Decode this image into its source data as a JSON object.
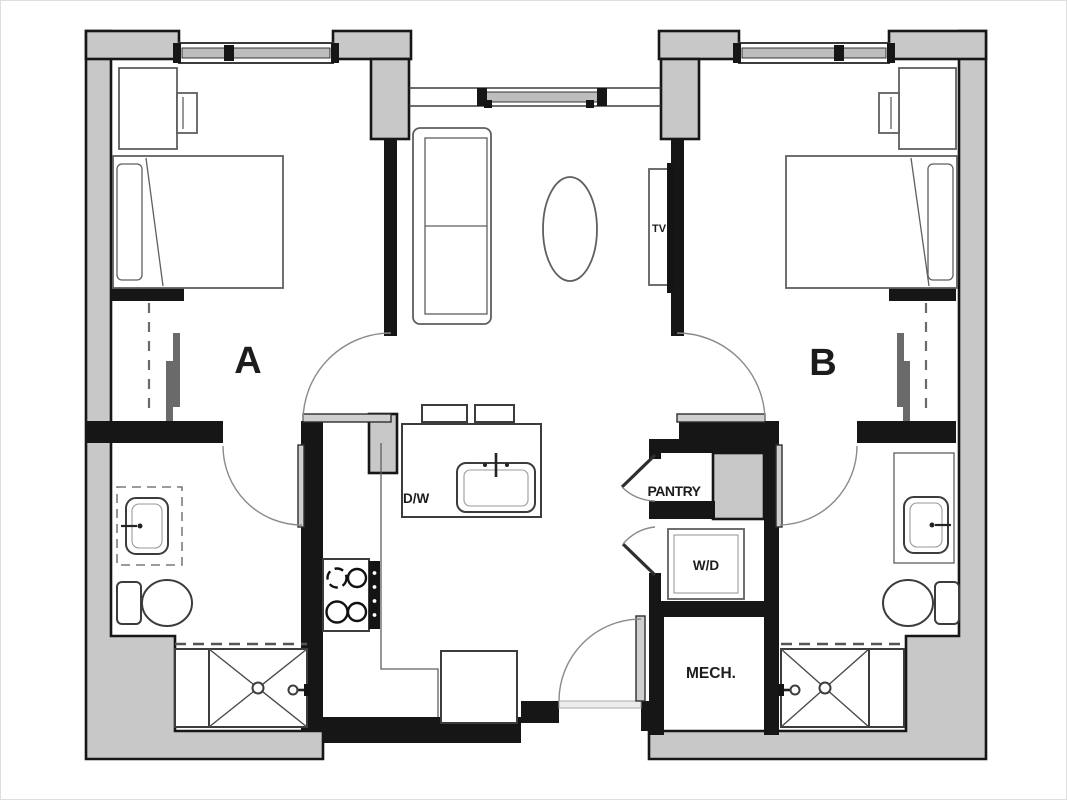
{
  "title": "Two-bedroom unit floor plan",
  "labels": {
    "bedroom_a": "A",
    "bedroom_b": "B",
    "tv": "TV",
    "dishwasher": "D/W",
    "pantry": "PANTRY",
    "washer_dryer": "W/D",
    "mechanical": "MECH."
  },
  "colors": {
    "wall_fill": "#c8c8c8",
    "wall_line": "#161616",
    "furniture_line": "#5f5f5f",
    "background": "#ffffff"
  }
}
